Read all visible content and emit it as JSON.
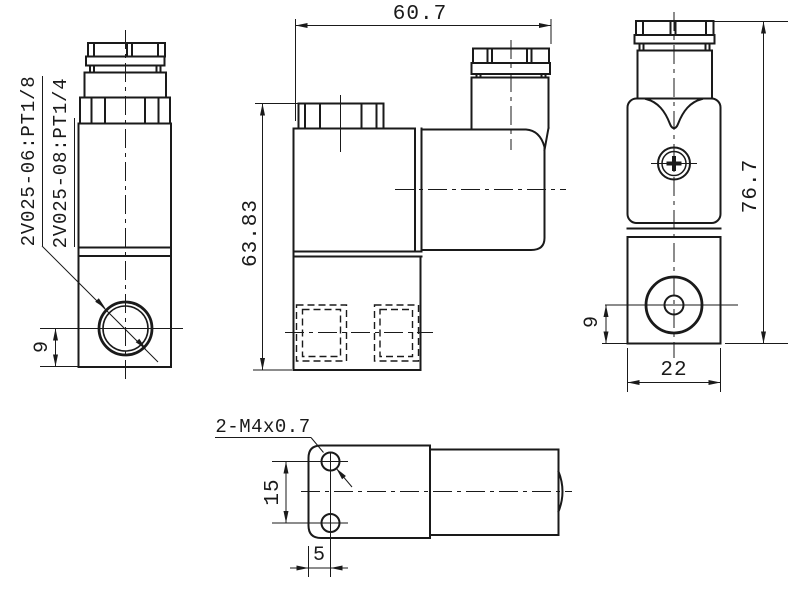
{
  "drawing": {
    "type": "engineering-dimension-drawing",
    "subject": "2V025 series solenoid valve, four orthographic views",
    "colors": {
      "line": "#1a1a1a",
      "background": "#ffffff"
    },
    "labels": {
      "model_1": "2V025-06:PT1/8",
      "model_2": "2V025-08:PT1/4",
      "mounting_holes": "2-M4x0.7"
    },
    "dims": {
      "left_port_offset": "9",
      "overall_width": "60.7",
      "body_height": "63.83",
      "overall_height": "76.7",
      "front_port_offset": "9",
      "body_width": "22",
      "hole_spacing": "15",
      "hole_offset": "5"
    }
  }
}
